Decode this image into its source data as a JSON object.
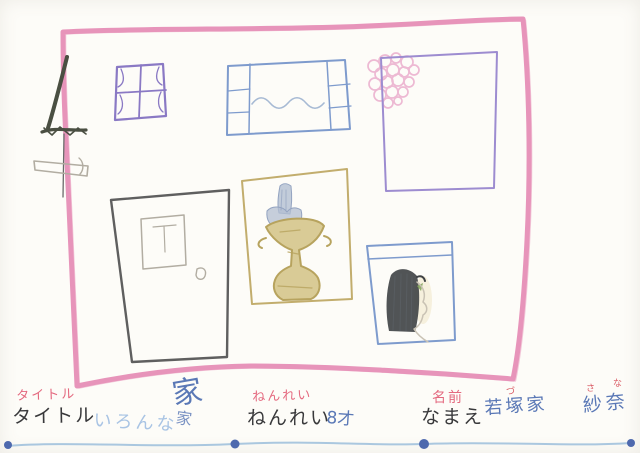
{
  "colors": {
    "paper": "#fdfcf8",
    "border_pink": "#e794ba",
    "crayon_black": "#4a4f42",
    "pencil": "#6a6a6a",
    "pencil_light": "#b2ada2",
    "window_purple": "#8a79c4",
    "frame_blue": "#7e9bcd",
    "wave_blue": "#a7bad4",
    "flower_pink": "#edb9d3",
    "square_purple": "#9d8cd0",
    "door_pencil": "#5f5f5f",
    "frame_tan": "#c2ad6d",
    "trophy_tan": "#b7a35e",
    "trophy_tan_light": "#d9cb96",
    "object_gray": "#b3bfd2",
    "object_gray_line": "#93a3c0",
    "hair_black": "#3e4144",
    "hair_line": "#5a5f64",
    "face_pencil": "#c9c2b4",
    "skin_tint": "#f0e4c2",
    "leaf_green": "#86a65e",
    "label_pink": "#e4697f",
    "text_black": "#39393b",
    "text_lightblue": "#a9c4e4",
    "text_blue": "#5a78b6",
    "furigana_red": "#d95862",
    "line_blue": "#aac7df",
    "bead_blue": "#4e69ae"
  },
  "drawing": {
    "elements": [
      {
        "name": "pink-house-outline",
        "color": "border_pink"
      },
      {
        "name": "antenna-scribble",
        "color": "crayon_black"
      },
      {
        "name": "flag-pencil-box",
        "color": "pencil_light"
      },
      {
        "name": "purple-window-with-curtains",
        "color": "window_purple"
      },
      {
        "name": "blue-framed-picture-wavy-line",
        "color": "frame_blue"
      },
      {
        "name": "pink-flower-cluster",
        "color": "flower_pink"
      },
      {
        "name": "purple-empty-frame",
        "color": "square_purple"
      },
      {
        "name": "pencil-door-with-window-and-knob",
        "color": "door_pencil"
      },
      {
        "name": "tan-frame-with-trophy",
        "color": "frame_tan"
      },
      {
        "name": "blue-frame-portrait-long-black-hair",
        "color": "frame_blue"
      },
      {
        "name": "beaded-wavy-underline",
        "color": "line_blue"
      }
    ]
  },
  "footer": {
    "title": {
      "label": "タイトル",
      "written_label": "タイトル",
      "value": "いろんな",
      "kanji": "家",
      "kanji_retry": "家"
    },
    "age": {
      "label": "ねんれい",
      "written_label": "ねんれい",
      "value": "8才"
    },
    "name": {
      "label": "名前",
      "written_label": "なまえ",
      "family": "若塚家",
      "family_furigana": "づ",
      "given": "紗奈",
      "given_furigana_1": "さ",
      "given_furigana_2": "な"
    }
  }
}
